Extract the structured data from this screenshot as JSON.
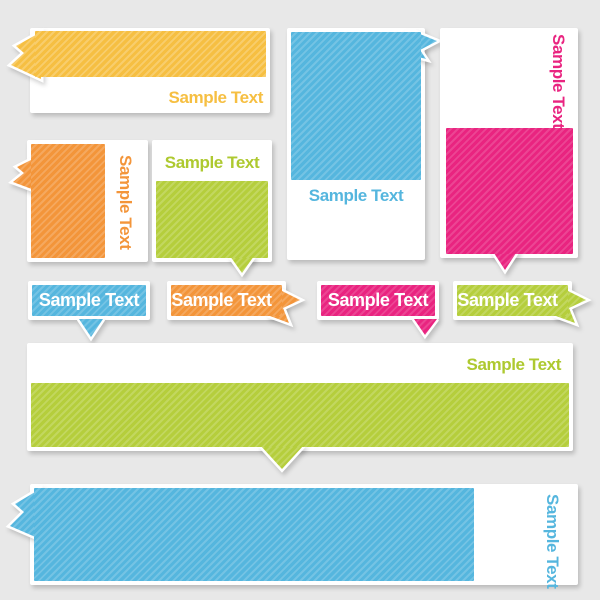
{
  "canvas": {
    "width": 600,
    "height": 600,
    "background": "#E8E8E8"
  },
  "palette": {
    "yellow": "#F6BF42",
    "blue": "#55B6DE",
    "pink": "#E92480",
    "orange": "#F3953A",
    "green": "#B5CE3C",
    "card_white": "#FFFFFF"
  },
  "banners": [
    {
      "id": "yellow-ribbon-card",
      "label": "Sample Text",
      "color": "#F6BF42",
      "text_color": "#F6BF42",
      "text_orientation": "horizontal"
    },
    {
      "id": "blue-tall-card",
      "label": "Sample Text",
      "color": "#55B6DE",
      "text_color": "#55B6DE",
      "text_orientation": "horizontal"
    },
    {
      "id": "pink-tall-card",
      "label": "Sample Text",
      "color": "#E92480",
      "text_color": "#E92480",
      "text_orientation": "vertical"
    },
    {
      "id": "orange-side-card",
      "label": "Sample Text",
      "color": "#F3953A",
      "text_color": "#F3953A",
      "text_orientation": "vertical"
    },
    {
      "id": "green-pointer-card",
      "label": "Sample Text",
      "color": "#B5CE3C",
      "text_color": "#AEC930",
      "text_orientation": "horizontal"
    },
    {
      "id": "blue-speech-bubble",
      "label": "Sample Text",
      "color": "#55B6DE",
      "text_color": "#FFFFFF",
      "text_orientation": "horizontal"
    },
    {
      "id": "orange-arrow-banner",
      "label": "Sample Text",
      "color": "#F3953A",
      "text_color": "#FFFFFF",
      "text_orientation": "horizontal"
    },
    {
      "id": "pink-speech-bubble",
      "label": "Sample Text",
      "color": "#E92480",
      "text_color": "#FFFFFF",
      "text_orientation": "horizontal"
    },
    {
      "id": "green-arrow-banner",
      "label": "Sample Text",
      "color": "#B5CE3C",
      "text_color": "#FFFFFF",
      "text_orientation": "horizontal"
    },
    {
      "id": "green-wide-banner",
      "label": "Sample Text",
      "color": "#B5CE3C",
      "text_color": "#AEC930",
      "text_orientation": "horizontal"
    },
    {
      "id": "blue-wide-banner",
      "label": "Sample Text",
      "color": "#55B6DE",
      "text_color": "#55B6DE",
      "text_orientation": "vertical"
    }
  ]
}
